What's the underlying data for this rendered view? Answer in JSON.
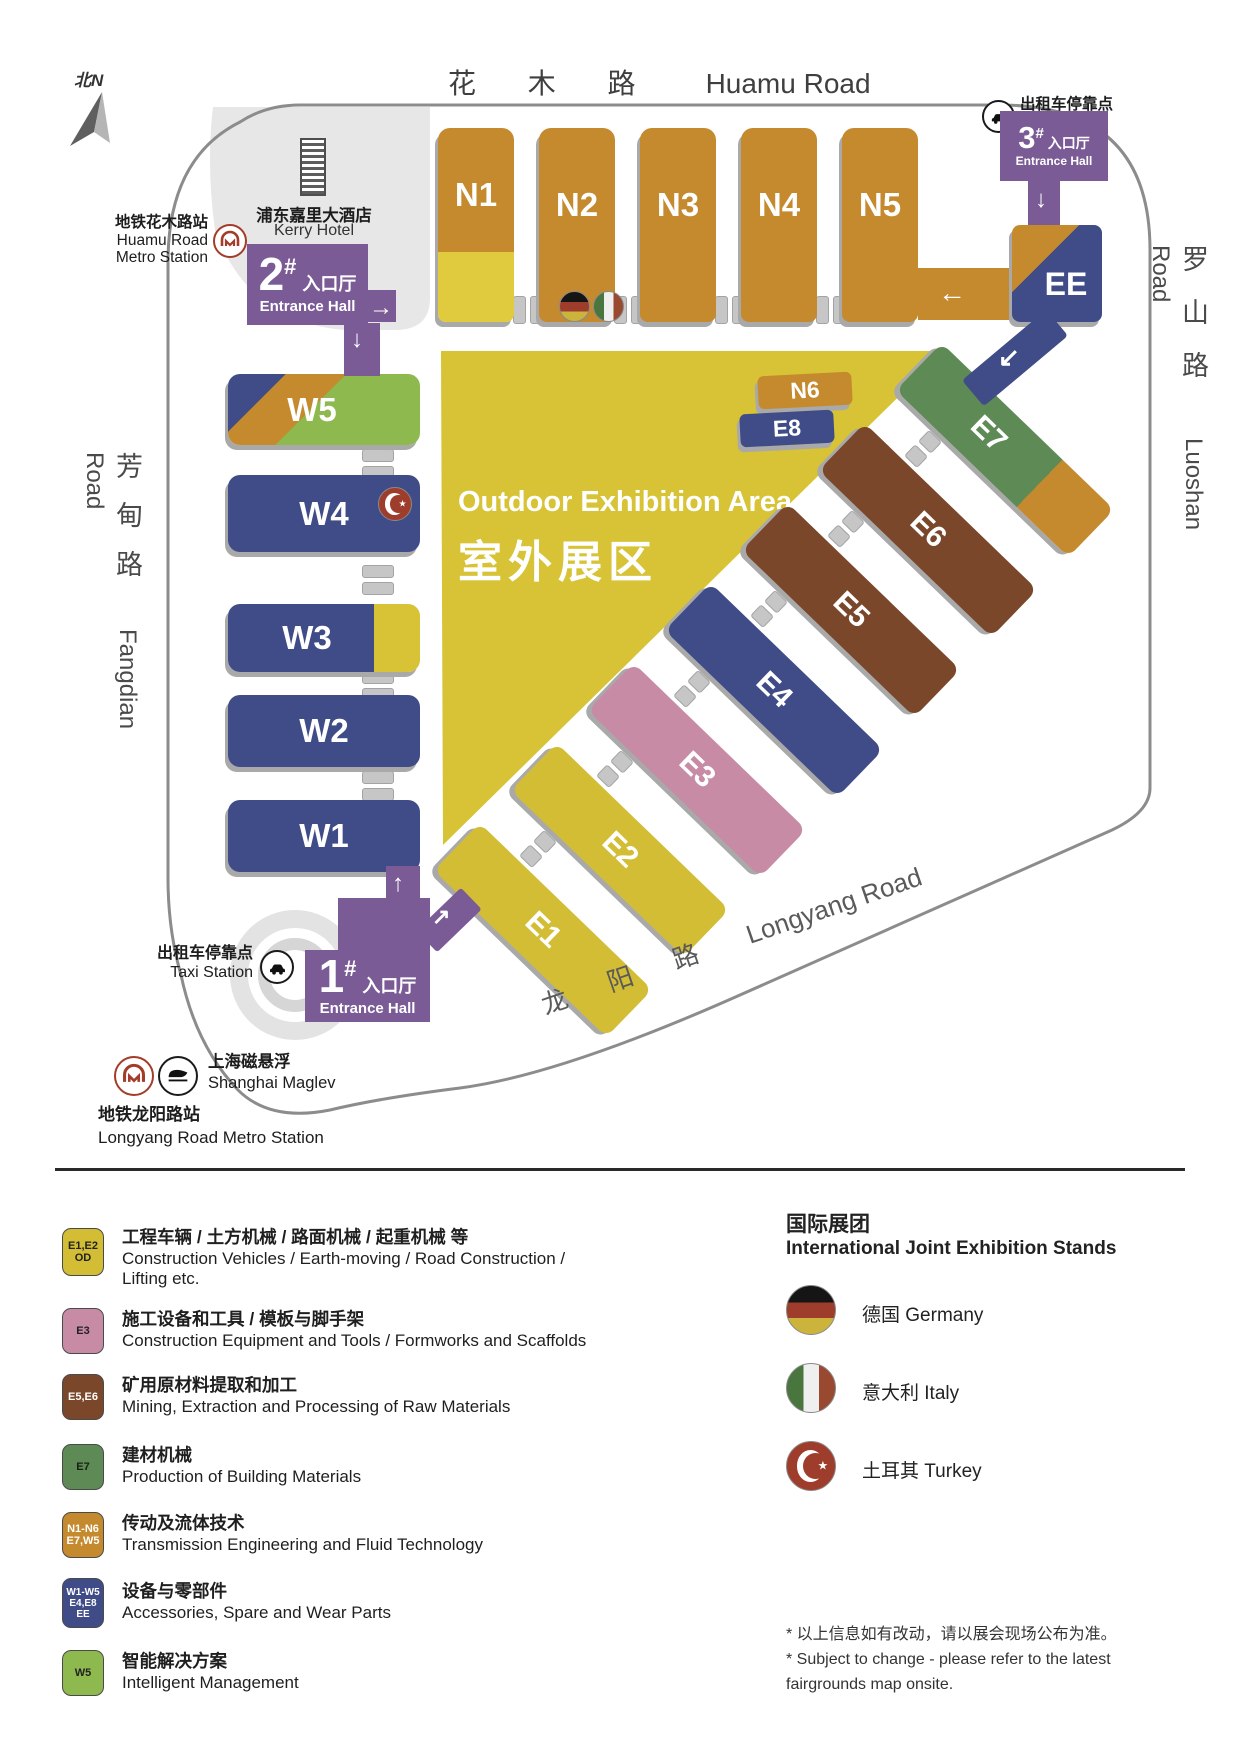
{
  "colors": {
    "purple": "#7a5b96",
    "hall_orange": "#c5892e",
    "hall_blue": "#3f4c87",
    "hall_yellow": "#d2bd35",
    "outdoor_yellow": "#d7c335",
    "pink": "#c78ba6",
    "brown": "#7a472a",
    "green_e7": "#5e8a56",
    "green_w5": "#8eb94e",
    "road_gray": "#8c8c8c"
  },
  "map": {
    "compass_label": "北N",
    "roads": {
      "huamu_cn": "花 木 路",
      "huamu_en": "Huamu Road",
      "luoshan_cn": "罗山路",
      "luoshan_en": "Luoshan Road",
      "fangdian_cn": "芳甸路",
      "fangdian_en": "Fangdian Road",
      "longyang_cn": "龙 阳 路",
      "longyang_en": "Longyang Road"
    },
    "kerry_hotel": {
      "cn": "浦东嘉里大酒店",
      "en": "Kerry Hotel"
    },
    "huamu_metro": {
      "cn": "地铁花木路站",
      "en1": "Huamu Road",
      "en2": "Metro Station"
    },
    "taxi_top": {
      "cn": "出租车停靠点",
      "en": "Taxi Station"
    },
    "taxi_bottom": {
      "cn": "出租车停靠点",
      "en": "Taxi Station"
    },
    "maglev": {
      "cn": "上海磁悬浮",
      "en": "Shanghai Maglev"
    },
    "longyang_metro": {
      "cn": "地铁龙阳路站",
      "en": "Longyang Road Metro Station"
    },
    "outdoor": {
      "en": "Outdoor Exhibition Area",
      "cn": "室外展区"
    },
    "entrances": [
      {
        "num": "1",
        "hash": "#",
        "cn": "入口厅",
        "en": "Entrance Hall"
      },
      {
        "num": "2",
        "hash": "#",
        "cn": "入口厅",
        "en": "Entrance Hall"
      },
      {
        "num": "3",
        "hash": "#",
        "cn": "入口厅",
        "en": "Entrance Hall"
      }
    ],
    "halls": {
      "n": [
        "N1",
        "N2",
        "N3",
        "N4",
        "N5"
      ],
      "n6": "N6",
      "e8": "E8",
      "w": [
        "W5",
        "W4",
        "W3",
        "W2",
        "W1"
      ],
      "e": [
        "E1",
        "E2",
        "E3",
        "E4",
        "E5",
        "E6",
        "E7"
      ],
      "ee": "EE"
    }
  },
  "legend": {
    "items": [
      {
        "badge": [
          "E1,E2",
          "OD"
        ],
        "color": "#d2bd35",
        "cn": "工程车辆 / 土方机械 / 路面机械 / 起重机械 等",
        "en1": "Construction Vehicles / Earth-moving / Road Construction /",
        "en2": "Lifting etc."
      },
      {
        "badge": [
          "E3"
        ],
        "color": "#c78ba6",
        "cn": "施工设备和工具 / 模板与脚手架",
        "en1": "Construction Equipment and Tools / Formworks and Scaffolds"
      },
      {
        "badge": [
          "E5,E6"
        ],
        "color": "#7a472a",
        "cn": "矿用原材料提取和加工",
        "en1": "Mining, Extraction and Processing of Raw Materials"
      },
      {
        "badge": [
          "E7"
        ],
        "color": "#5e8a56",
        "cn": "建材机械",
        "en1": "Production of Building Materials"
      },
      {
        "badge": [
          "N1-N6",
          "E7,W5"
        ],
        "color": "#c5892e",
        "cn": "传动及流体技术",
        "en1": "Transmission Engineering and Fluid Technology"
      },
      {
        "badge": [
          "W1-W5",
          "E4,E8",
          "EE"
        ],
        "color": "#3f4c87",
        "cn": "设备与零部件",
        "en1": "Accessories, Spare and Wear Parts"
      },
      {
        "badge": [
          "W5"
        ],
        "color": "#8eb94e",
        "cn": "智能解决方案",
        "en1": "Intelligent Management"
      }
    ]
  },
  "international": {
    "title_cn": "国际展团",
    "title_en": "International Joint Exhibition Stands",
    "entries": [
      {
        "label": "德国 Germany"
      },
      {
        "label": "意大利 Italy"
      },
      {
        "label": "土耳其 Turkey"
      }
    ]
  },
  "footnote": {
    "l1": "* 以上信息如有改动，请以展会现场公布为准。",
    "l2": "* Subject to change - please refer to the latest",
    "l3": "fairgrounds map onsite."
  }
}
